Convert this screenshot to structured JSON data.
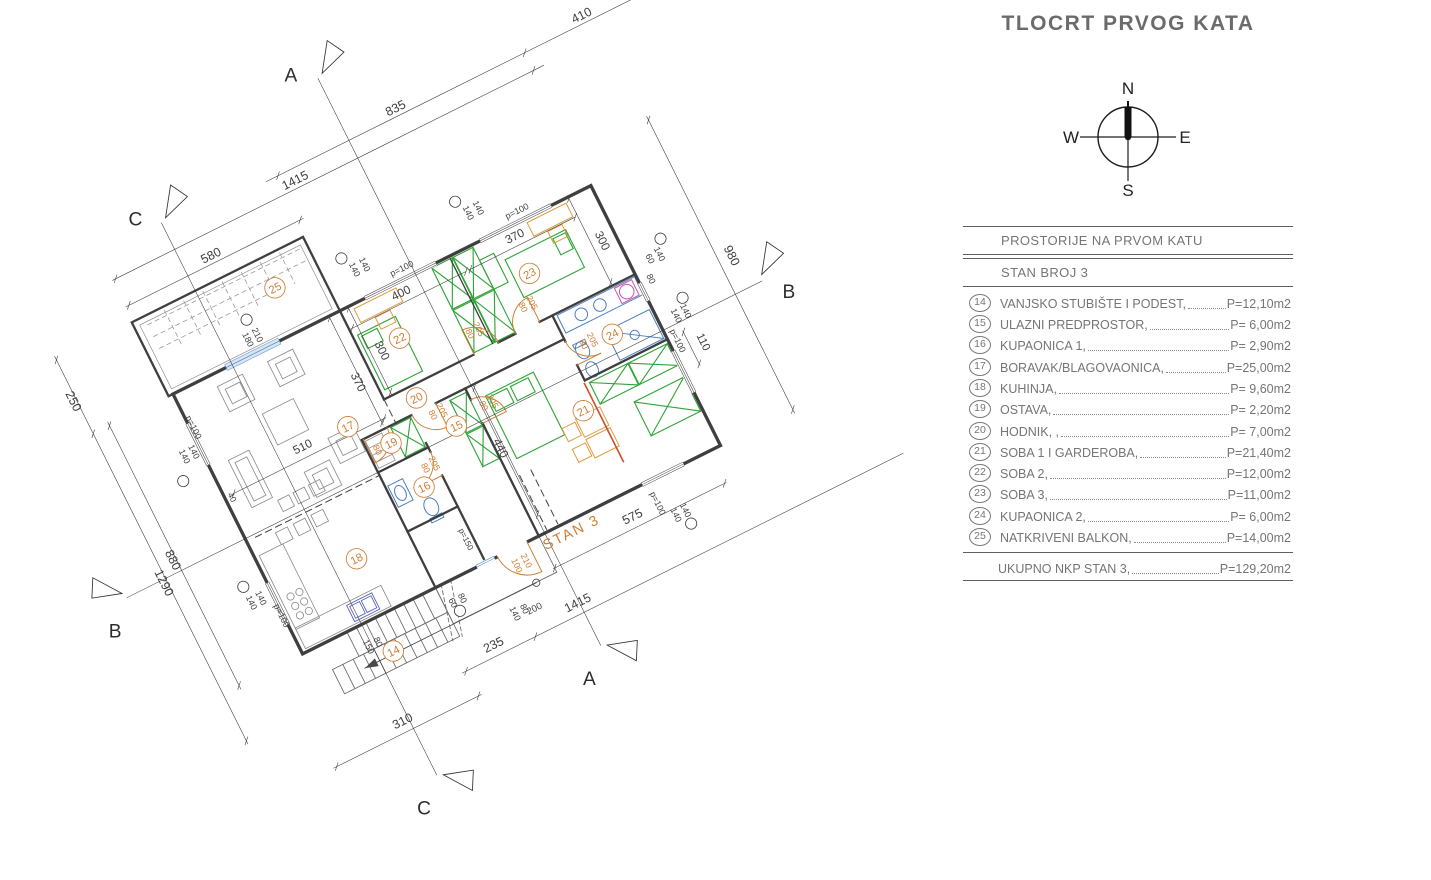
{
  "title": "TLOCRT PRVOG KATA",
  "compass": {
    "n": "N",
    "e": "E",
    "s": "S",
    "w": "W"
  },
  "table": {
    "header": "PROSTORIJE NA PRVOM KATU",
    "subheader": "STAN BROJ 3",
    "rows": [
      {
        "no": "14",
        "label": "VANJSKO STUBIŠTE I PODEST,",
        "area": "P=12,10m2"
      },
      {
        "no": "15",
        "label": "ULAZNI PREDPROSTOR,",
        "area": "P=  6,00m2"
      },
      {
        "no": "16",
        "label": "KUPAONICA 1,",
        "area": "P=  2,90m2"
      },
      {
        "no": "17",
        "label": "BORAVAK/BLAGOVAONICA,",
        "area": "P=25,00m2"
      },
      {
        "no": "18",
        "label": "KUHINJA,",
        "area": "P=  9,60m2"
      },
      {
        "no": "19",
        "label": "OSTAVA,",
        "area": "P=  2,20m2"
      },
      {
        "no": "20",
        "label": "HODNIK, ,",
        "area": "P=  7,00m2"
      },
      {
        "no": "21",
        "label": "SOBA 1 I GARDEROBA,",
        "area": "P=21,40m2"
      },
      {
        "no": "22",
        "label": "SOBA 2,",
        "area": "P=12,00m2"
      },
      {
        "no": "23",
        "label": "SOBA 3,",
        "area": "P=11,00m2"
      },
      {
        "no": "24",
        "label": "KUPAONICA 2,",
        "area": "P=  6,00m2"
      },
      {
        "no": "25",
        "label": "NATKRIVENI BALKON,",
        "area": "P=14,00m2"
      }
    ],
    "total": {
      "label": "UKUPNO NKP STAN 3,",
      "area": "P=129,20m2"
    }
  },
  "plan": {
    "apartment_label": "STAN 3",
    "colors": {
      "k": "#3f3f3f",
      "o": "#cf7e33"
    },
    "rooms": [
      [
        "14",
        250,
        995
      ],
      [
        "15",
        725,
        470
      ],
      [
        "16",
        555,
        592
      ],
      [
        "17",
        430,
        325
      ],
      [
        "18",
        275,
        695
      ],
      [
        "19",
        525,
        428
      ],
      [
        "20",
        655,
        340
      ],
      [
        "21",
        1090,
        600
      ],
      [
        "22",
        690,
        155
      ],
      [
        "23",
        1130,
        155
      ],
      [
        "24",
        1272,
        432
      ],
      [
        "25",
        420,
        -150
      ]
    ],
    "marks": [
      [
        640,
        -140
      ],
      [
        1025,
        -140
      ],
      [
        -90,
        250
      ],
      [
        -70,
        618
      ],
      [
        300,
        -102
      ],
      [
        1532,
        238
      ],
      [
        1512,
        428
      ],
      [
        1230,
        1052
      ],
      [
        485,
        976
      ]
    ],
    "dims": [
      [
        "835",
        990,
        -462,
        0,
        38,
        "k"
      ],
      [
        "410",
        1620,
        -462,
        0,
        38,
        "k"
      ],
      [
        "1415",
        620,
        -402,
        0,
        38,
        "k"
      ],
      [
        "580",
        290,
        -312,
        0,
        38,
        "k"
      ],
      [
        "400",
        755,
        46,
        0,
        36,
        "k"
      ],
      [
        "370",
        1140,
        46,
        0,
        36,
        "k"
      ],
      [
        "p=100",
        790,
        -22,
        0,
        27,
        "k"
      ],
      [
        "p=100",
        1180,
        -22,
        0,
        27,
        "k"
      ],
      [
        "140",
        652,
        -92,
        90,
        27,
        "k"
      ],
      [
        "140",
        686,
        -92,
        90,
        27,
        "k"
      ],
      [
        "140",
        1037,
        -92,
        90,
        27,
        "k"
      ],
      [
        "140",
        1071,
        -92,
        90,
        27,
        "k"
      ],
      [
        "250",
        -292,
        -115,
        90,
        38,
        "k"
      ],
      [
        "1290",
        -292,
        500,
        90,
        38,
        "k"
      ],
      [
        "880",
        -237,
        450,
        90,
        38,
        "k"
      ],
      [
        "140",
        -62,
        185,
        90,
        27,
        "k"
      ],
      [
        "140",
        -30,
        185,
        90,
        27,
        "k"
      ],
      [
        "p=100",
        2,
        118,
        90,
        27,
        "k"
      ],
      [
        "140",
        -78,
        672,
        90,
        27,
        "k"
      ],
      [
        "140",
        -46,
        672,
        90,
        27,
        "k"
      ],
      [
        "p=100",
        -14,
        748,
        90,
        27,
        "k"
      ],
      [
        "180",
        268,
        -46,
        90,
        27,
        "k"
      ],
      [
        "210",
        300,
        -46,
        90,
        27,
        "k"
      ],
      [
        "980",
        1690,
        380,
        90,
        38,
        "k"
      ],
      [
        "60",
        1468,
        278,
        90,
        27,
        "k"
      ],
      [
        "140",
        1500,
        278,
        90,
        27,
        "k"
      ],
      [
        "80",
        1443,
        334,
        90,
        27,
        "k"
      ],
      [
        "140",
        1462,
        468,
        90,
        27,
        "k"
      ],
      [
        "140",
        1494,
        468,
        90,
        27,
        "k"
      ],
      [
        "p=100",
        1432,
        538,
        90,
        27,
        "k"
      ],
      [
        "110",
        1498,
        576,
        90,
        34,
        "k"
      ],
      [
        "575",
        1080,
        966,
        0,
        38,
        "k"
      ],
      [
        "235",
        530,
        1126,
        0,
        38,
        "k"
      ],
      [
        "1415",
        815,
        1126,
        0,
        38,
        "k"
      ],
      [
        "200",
        690,
        1080,
        0,
        29,
        "k"
      ],
      [
        "310",
        180,
        1210,
        0,
        38,
        "k"
      ],
      [
        "140",
        622,
        1058,
        90,
        27,
        "k"
      ],
      [
        "80",
        654,
        1058,
        90,
        27,
        "k"
      ],
      [
        "150",
        180,
        950,
        90,
        27,
        "k"
      ],
      [
        "80",
        212,
        950,
        90,
        27,
        "k"
      ],
      [
        "60",
        468,
        945,
        90,
        27,
        "k"
      ],
      [
        "80",
        500,
        945,
        90,
        27,
        "k"
      ],
      [
        "p=150",
        590,
        790,
        90,
        25,
        "k"
      ],
      [
        "140",
        1192,
        1008,
        90,
        27,
        "k"
      ],
      [
        "140",
        1224,
        1008,
        90,
        27,
        "k"
      ],
      [
        "p=100",
        1158,
        952,
        90,
        27,
        "k"
      ],
      [
        "510",
        280,
        330,
        0,
        36,
        "k"
      ],
      [
        "440",
        804,
        590,
        90,
        36,
        "k"
      ],
      [
        "300",
        614,
        165,
        90,
        36,
        "k"
      ],
      [
        "300",
        1360,
        165,
        90,
        36,
        "k"
      ],
      [
        "370",
        507,
        218,
        90,
        36,
        "k"
      ],
      [
        "40",
        12,
        360,
        90,
        26,
        "k"
      ],
      [
        "80",
        878,
        238,
        90,
        27,
        "o"
      ],
      [
        "205",
        908,
        238,
        90,
        27,
        "o"
      ],
      [
        "80",
        1058,
        238,
        90,
        27,
        "o"
      ],
      [
        "205",
        1088,
        238,
        90,
        27,
        "o"
      ],
      [
        "80",
        1172,
        420,
        90,
        27,
        "o"
      ],
      [
        "205",
        1202,
        420,
        90,
        27,
        "o"
      ],
      [
        "80",
        818,
        452,
        90,
        27,
        "o"
      ],
      [
        "205",
        848,
        452,
        90,
        27,
        "o"
      ],
      [
        "80",
        470,
        428,
        90,
        27,
        "o"
      ],
      [
        "205",
        500,
        428,
        90,
        27,
        "o"
      ],
      [
        "80",
        576,
        542,
        90,
        27,
        "o"
      ],
      [
        "205",
        606,
        542,
        90,
        27,
        "o"
      ],
      [
        "80",
        668,
        408,
        90,
        27,
        "o"
      ],
      [
        "205",
        698,
        408,
        90,
        27,
        "o"
      ],
      [
        "100",
        692,
        930,
        90,
        27,
        "o"
      ],
      [
        "210",
        724,
        930,
        90,
        27,
        "o"
      ]
    ],
    "sections": [
      {
        "t": "A",
        "x": 742,
        "y": -688
      },
      {
        "t": "A",
        "x": 736,
        "y": 1352
      },
      {
        "t": "B",
        "x": -486,
        "y": 582
      },
      {
        "t": "B",
        "x": 1800,
        "y": 572
      },
      {
        "t": "C",
        "x": 126,
        "y": -508
      },
      {
        "t": "C",
        "x": 112,
        "y": 1480
      }
    ]
  }
}
